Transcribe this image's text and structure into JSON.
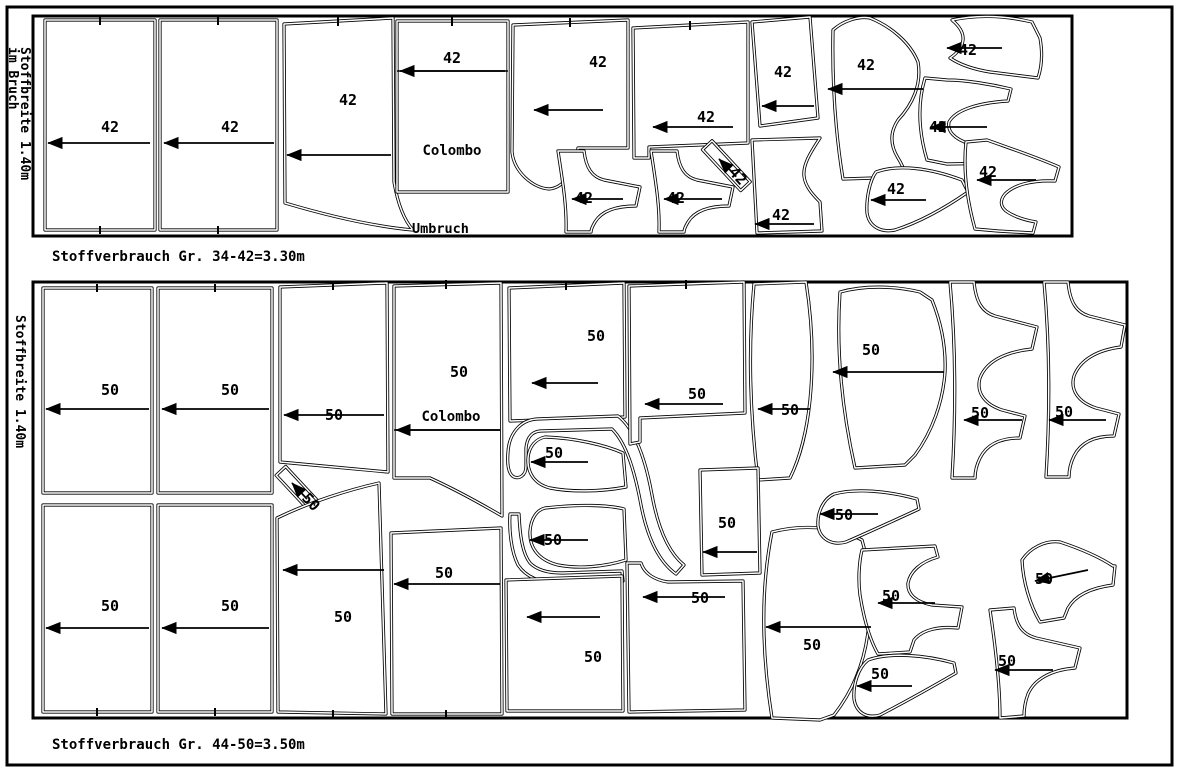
{
  "document": {
    "background": "#ffffff",
    "line_color": "#000000",
    "type_note": "sewing pattern cutting layout"
  },
  "panels": [
    {
      "id": "top",
      "size_range": "34-42",
      "caption": "Stoffverbrauch Gr. 34-42=3.30m",
      "side_label_line1": "Stoffbreite 1.40m",
      "side_label_line2": "im Bruch",
      "fold_label": "Umbruch",
      "brand_label": {
        "text": "Colombo"
      },
      "pieces": [
        {
          "label": "42",
          "lx": 110,
          "ly": 127,
          "arrow": [
            150,
            143,
            48,
            143
          ]
        },
        {
          "label": "42",
          "lx": 230,
          "ly": 127,
          "arrow": [
            274,
            143,
            164,
            143
          ]
        },
        {
          "label": "42",
          "lx": 348,
          "ly": 100,
          "arrow": [
            391,
            155,
            287,
            155
          ]
        },
        {
          "label": "42",
          "lx": 452,
          "ly": 58,
          "arrow": [
            505,
            71,
            400,
            71
          ]
        },
        {
          "label": "42",
          "lx": 598,
          "ly": 62,
          "arrow": [
            603,
            110,
            534,
            110
          ]
        },
        {
          "label": "42",
          "lx": 706,
          "ly": 117,
          "arrow": [
            733,
            127,
            653,
            127
          ]
        },
        {
          "label": "42",
          "lx": 584,
          "ly": 198,
          "arrow": [
            623,
            199,
            572,
            199
          ]
        },
        {
          "label": "42",
          "lx": 676,
          "ly": 198,
          "arrow": [
            722,
            199,
            664,
            199
          ]
        },
        {
          "label": "42",
          "lx": 738,
          "ly": 176,
          "rot": 47,
          "arrow": [
            734,
            174,
            719,
            159
          ]
        },
        {
          "label": "42",
          "lx": 783,
          "ly": 72,
          "arrow": [
            814,
            106,
            762,
            106
          ]
        },
        {
          "label": "42",
          "lx": 781,
          "ly": 215,
          "arrow": [
            814,
            224,
            755,
            224
          ]
        },
        {
          "label": "42",
          "lx": 866,
          "ly": 65,
          "arrow": [
            923,
            89,
            828,
            89
          ]
        },
        {
          "label": "42",
          "lx": 968,
          "ly": 50,
          "arrow": [
            1002,
            48,
            947,
            48
          ]
        },
        {
          "label": "42",
          "lx": 938,
          "ly": 127,
          "arrow": [
            987,
            127,
            931,
            127
          ]
        },
        {
          "label": "42",
          "lx": 896,
          "ly": 189,
          "arrow": [
            926,
            200,
            871,
            200
          ]
        },
        {
          "label": "42",
          "lx": 988,
          "ly": 172,
          "arrow": [
            1036,
            180,
            977,
            180
          ]
        }
      ]
    },
    {
      "id": "bottom",
      "size_range": "44-50",
      "caption": "Stoffverbrauch Gr. 44-50=3.50m",
      "side_label_line1": "Stoffbreite 1.40m",
      "side_label_line2": "",
      "fold_label": "",
      "brand_label": {
        "text": "Colombo"
      },
      "pieces": [
        {
          "label": "50",
          "lx": 110,
          "ly": 390,
          "arrow": [
            149,
            409,
            46,
            409
          ]
        },
        {
          "label": "50",
          "lx": 230,
          "ly": 390,
          "arrow": [
            269,
            409,
            162,
            409
          ]
        },
        {
          "label": "50",
          "lx": 334,
          "ly": 415,
          "arrow": [
            384,
            415,
            284,
            415
          ]
        },
        {
          "label": "50",
          "lx": 459,
          "ly": 372,
          "arrow": [
            500,
            430,
            396,
            430
          ]
        },
        {
          "label": "50",
          "lx": 596,
          "ly": 336,
          "arrow": [
            598,
            383,
            532,
            383
          ]
        },
        {
          "label": "50",
          "lx": 554,
          "ly": 453,
          "arrow": [
            588,
            462,
            531,
            462
          ]
        },
        {
          "label": "50",
          "lx": 697,
          "ly": 394,
          "arrow": [
            723,
            404,
            645,
            404
          ]
        },
        {
          "label": "50",
          "lx": 790,
          "ly": 410,
          "arrow": [
            810,
            409,
            758,
            409
          ]
        },
        {
          "label": "50",
          "lx": 871,
          "ly": 350,
          "arrow": [
            944,
            372,
            833,
            372
          ]
        },
        {
          "label": "50",
          "lx": 980,
          "ly": 413,
          "arrow": [
            1022,
            420,
            964,
            420
          ]
        },
        {
          "label": "50",
          "lx": 1064,
          "ly": 412,
          "arrow": [
            1106,
            420,
            1049,
            420
          ]
        },
        {
          "label": "50",
          "lx": 311,
          "ly": 502,
          "rot": 47,
          "arrow": [
            307,
            499,
            292,
            483
          ]
        },
        {
          "label": "50",
          "lx": 110,
          "ly": 606,
          "arrow": [
            149,
            628,
            46,
            628
          ]
        },
        {
          "label": "50",
          "lx": 230,
          "ly": 606,
          "arrow": [
            269,
            628,
            162,
            628
          ]
        },
        {
          "label": "50",
          "lx": 343,
          "ly": 617,
          "arrow": [
            384,
            570,
            283,
            570
          ]
        },
        {
          "label": "50",
          "lx": 444,
          "ly": 573,
          "arrow": [
            500,
            584,
            394,
            584
          ]
        },
        {
          "label": "50",
          "lx": 553,
          "ly": 540,
          "arrow": [
            588,
            540,
            530,
            540
          ]
        },
        {
          "label": "50",
          "lx": 593,
          "ly": 657,
          "arrow": [
            600,
            617,
            527,
            617
          ]
        },
        {
          "label": "50",
          "lx": 700,
          "ly": 598,
          "arrow": [
            725,
            597,
            643,
            597
          ]
        },
        {
          "label": "50",
          "lx": 727,
          "ly": 523,
          "arrow": [
            757,
            552,
            703,
            552
          ]
        },
        {
          "label": "50",
          "lx": 812,
          "ly": 645,
          "arrow": [
            871,
            627,
            766,
            627
          ]
        },
        {
          "label": "50",
          "lx": 844,
          "ly": 515,
          "arrow": [
            878,
            514,
            820,
            514
          ]
        },
        {
          "label": "50",
          "lx": 891,
          "ly": 596,
          "arrow": [
            935,
            603,
            878,
            603
          ]
        },
        {
          "label": "50",
          "lx": 880,
          "ly": 674,
          "arrow": [
            912,
            686,
            857,
            686
          ]
        },
        {
          "label": "50",
          "lx": 1007,
          "ly": 661,
          "arrow": [
            1053,
            670,
            995,
            670
          ]
        },
        {
          "label": "50",
          "lx": 1044,
          "ly": 579,
          "arrow": [
            1088,
            570,
            1035,
            581
          ]
        }
      ]
    }
  ]
}
